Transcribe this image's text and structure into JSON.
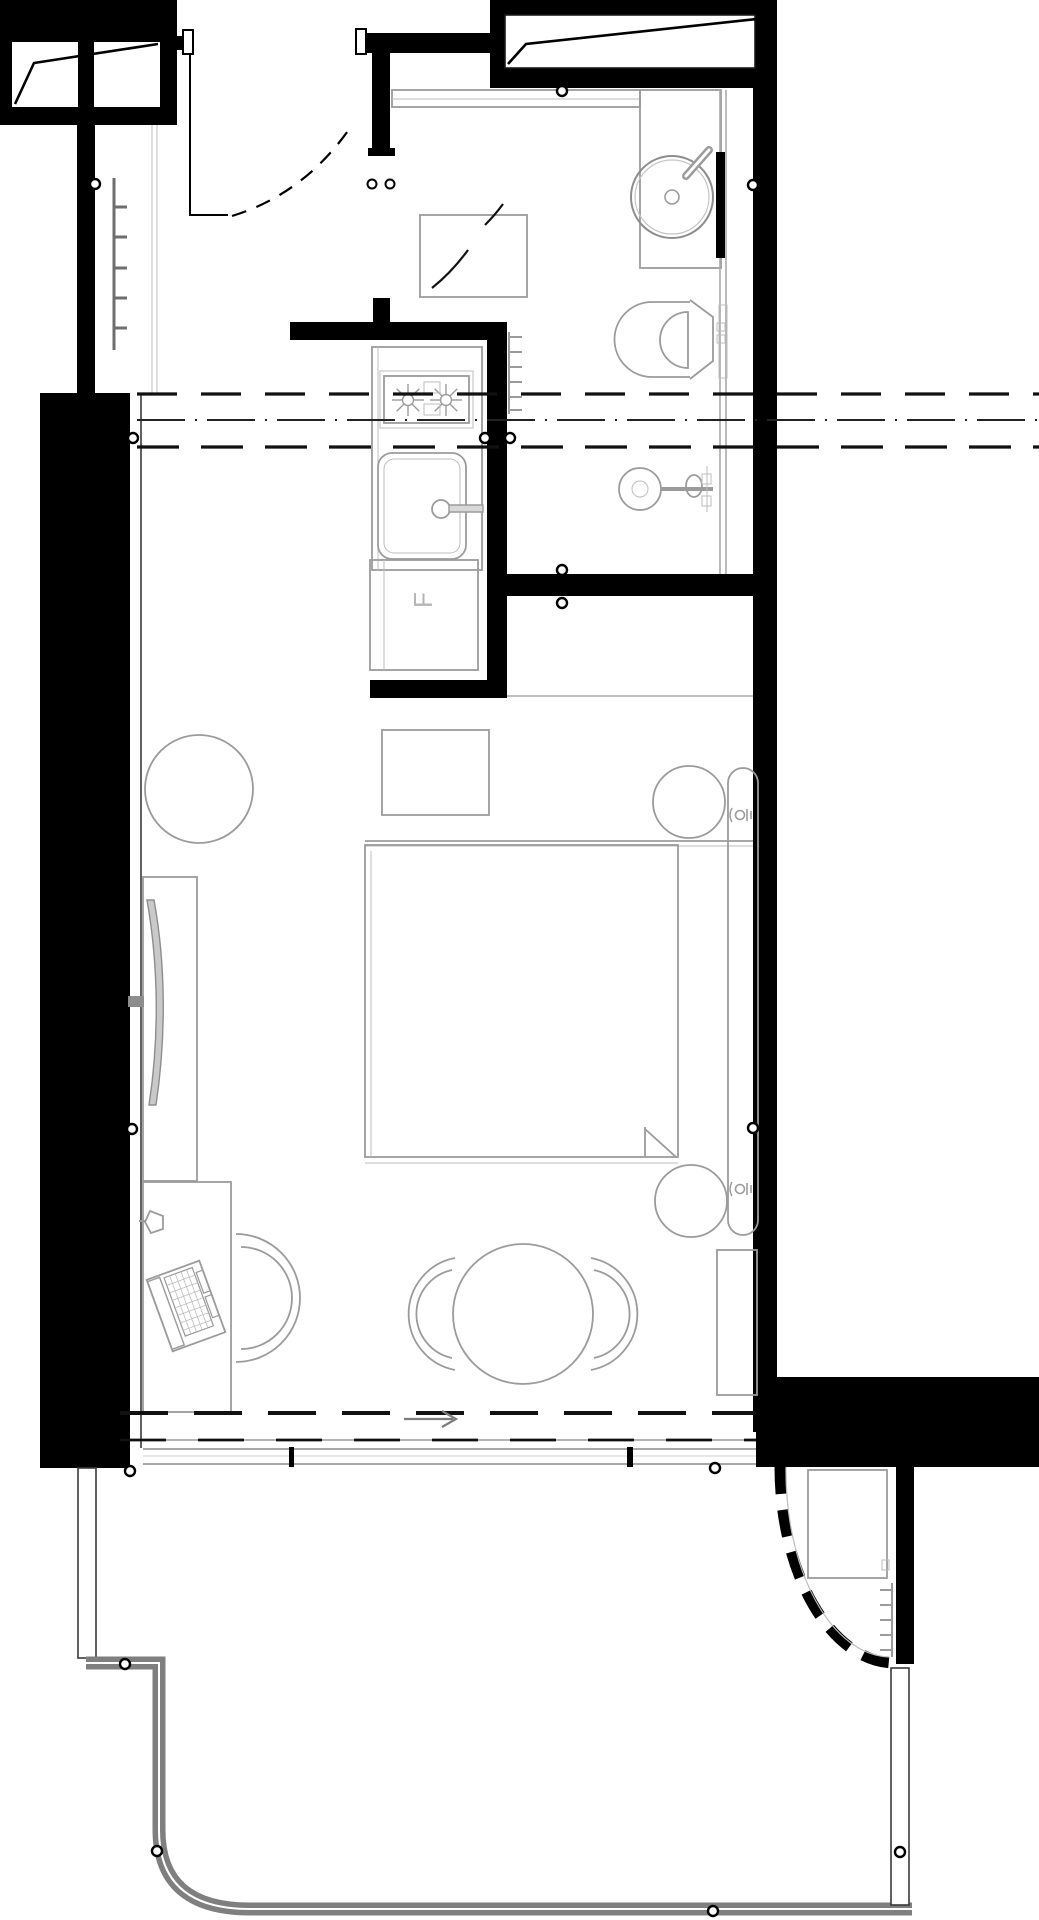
{
  "meta": {
    "type": "architectural-floor-plan",
    "description": "Black-and-white CAD floor plan of a studio hotel room: entry hall, bathroom, kitchenette, combined bedroom-living zone with desk and dining table, and a curved balcony at bottom right",
    "orientation": "portrait",
    "scale_px": {
      "width": 1039,
      "height": 1920
    }
  },
  "labels": {
    "fridge": "F"
  },
  "colors": {
    "wall": "#000000",
    "furniture_line": "#9b9b9b",
    "light_line": "#bdbdbd",
    "glass_line": "#aaaaaa",
    "balcony_band": "#7f7f7f",
    "background": "#ffffff",
    "datum_dash": "#111111"
  },
  "rooms": [
    {
      "name": "entry-hall"
    },
    {
      "name": "bathroom"
    },
    {
      "name": "kitchenette"
    },
    {
      "name": "bedroom-living"
    },
    {
      "name": "balcony"
    }
  ],
  "fixtures": {
    "entry": [
      "entry-door-swing",
      "door-pivot-points",
      "entry-bench-mat",
      "hall-closet"
    ],
    "bathroom": [
      "vanity-counter",
      "round-washbasin",
      "basin-faucet",
      "mirror-strip",
      "glass-partition",
      "toilet",
      "shower-mixer-and-drain",
      "towel-radiator"
    ],
    "kitchenette": [
      "kitchen-counter",
      "two-burner-hob",
      "kitchen-sink",
      "kitchen-faucet",
      "fridge-cabinet"
    ],
    "bedroom_living": [
      "double-bed",
      "headboard-bench-cushion",
      "upholstered-wall-panel",
      "bedside-lamp-top",
      "bedside-lamp-bottom",
      "wall-sconce-top",
      "wall-sconce-bottom",
      "minibar-cabinet",
      "plant-pot",
      "wall-tv",
      "tv-panel",
      "work-desk",
      "desk-lamp",
      "laptop",
      "desk-tub-chair",
      "round-dining-table",
      "dining-chair-left",
      "dining-chair-right",
      "radiator-left"
    ],
    "balcony": [
      "balcony-railing",
      "curved-dashed-glazing-wall",
      "planter-unit",
      "trellis-rungs"
    ],
    "annotations": [
      "datum-dash-lines-upper",
      "datum-dash-lines-lower",
      "flow-arrow",
      "survey-point-circles",
      "window-sill-band"
    ]
  }
}
